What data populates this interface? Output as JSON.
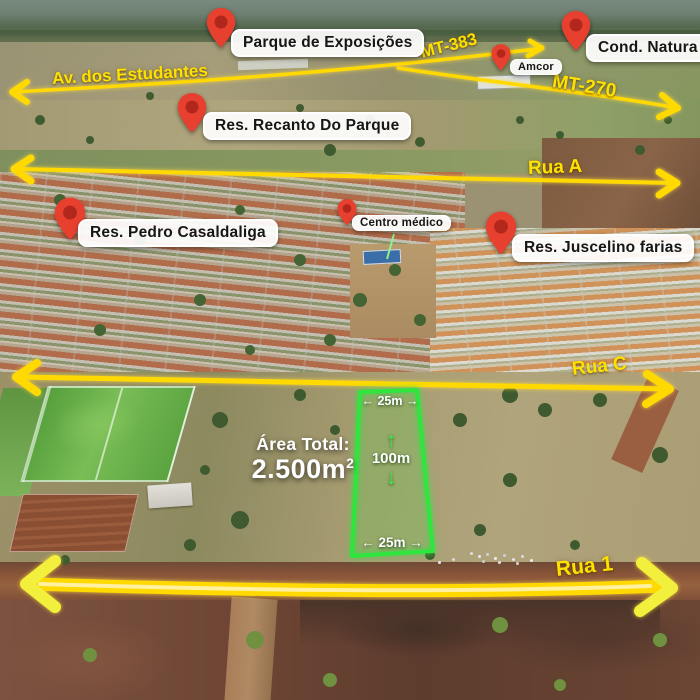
{
  "pins": {
    "parque": "Parque de Exposições",
    "natura": "Cond. Natura",
    "amcor": "Amcor",
    "recanto": "Res. Recanto Do Parque",
    "pedro": "Res. Pedro Casaldaliga",
    "centro": "Centro médico",
    "juscelino": "Res. Juscelino farias"
  },
  "roads": {
    "estudantes": "Av. dos Estudantes",
    "mt383": "MT-383",
    "mt270": "MT-270",
    "rua_a": "Rua A",
    "rua_c": "Rua C",
    "rua_1": "Rua 1"
  },
  "plot": {
    "width_top": "25m",
    "width_bottom": "25m",
    "depth": "100m",
    "area_label": "Área Total:",
    "area_value": "2.500m",
    "area_sup": "2",
    "arrow_left": "←",
    "arrow_right": "→",
    "arrow_up": "↑",
    "arrow_down": "↓"
  },
  "colors": {
    "road_yellow": "#ffd900",
    "road_text_yellow": "#ffe100",
    "pin_red": "#e8402f",
    "pin_inner": "#b2271b",
    "plot_green": "#2ee63c",
    "label_bg": "#ffffff",
    "label_text": "#161616"
  }
}
